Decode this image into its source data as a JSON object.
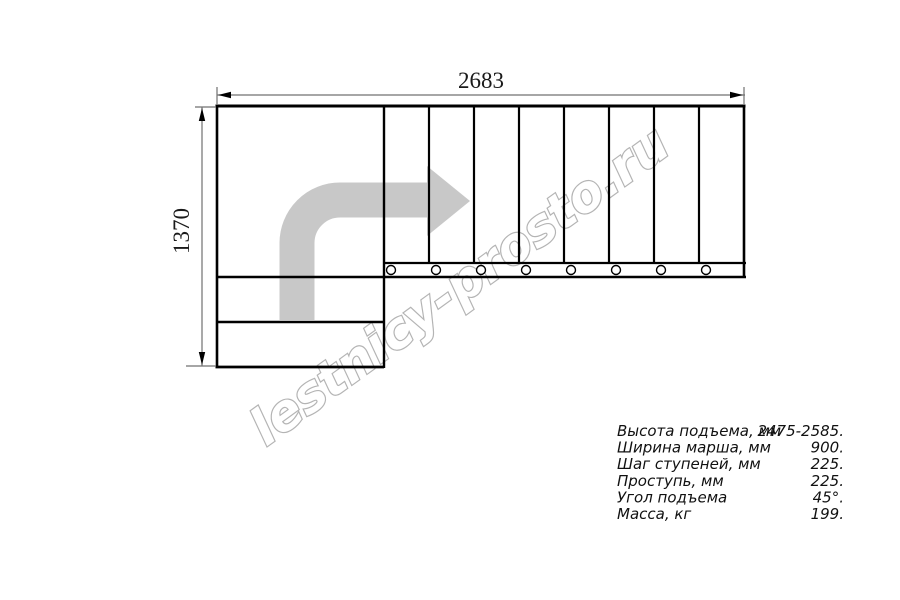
{
  "window": {
    "background": "#ffffff"
  },
  "drawing": {
    "type": "staircase-plan-top-view",
    "width_dimension": "2683",
    "height_dimension": "1370",
    "watermark": "lestnicy-prosto.ru",
    "upper_flight_steps": 8,
    "lower_steps": 2,
    "colors": {
      "lines": "#000000",
      "dimension_lines": "#707070",
      "arrow": "#c8c8c8",
      "watermark_outline": "#b4b4b4"
    }
  },
  "specs": {
    "rows": [
      {
        "label": "Высота подъема, мм",
        "value": "2475-2585."
      },
      {
        "label": "Ширина марша, мм",
        "value": "900."
      },
      {
        "label": "Шаг ступеней, мм",
        "value": "225."
      },
      {
        "label": "Проступь, мм",
        "value": "225."
      },
      {
        "label": "Угол подъема",
        "value": "45°."
      },
      {
        "label": "Масса, кг",
        "value": "199."
      }
    ]
  }
}
